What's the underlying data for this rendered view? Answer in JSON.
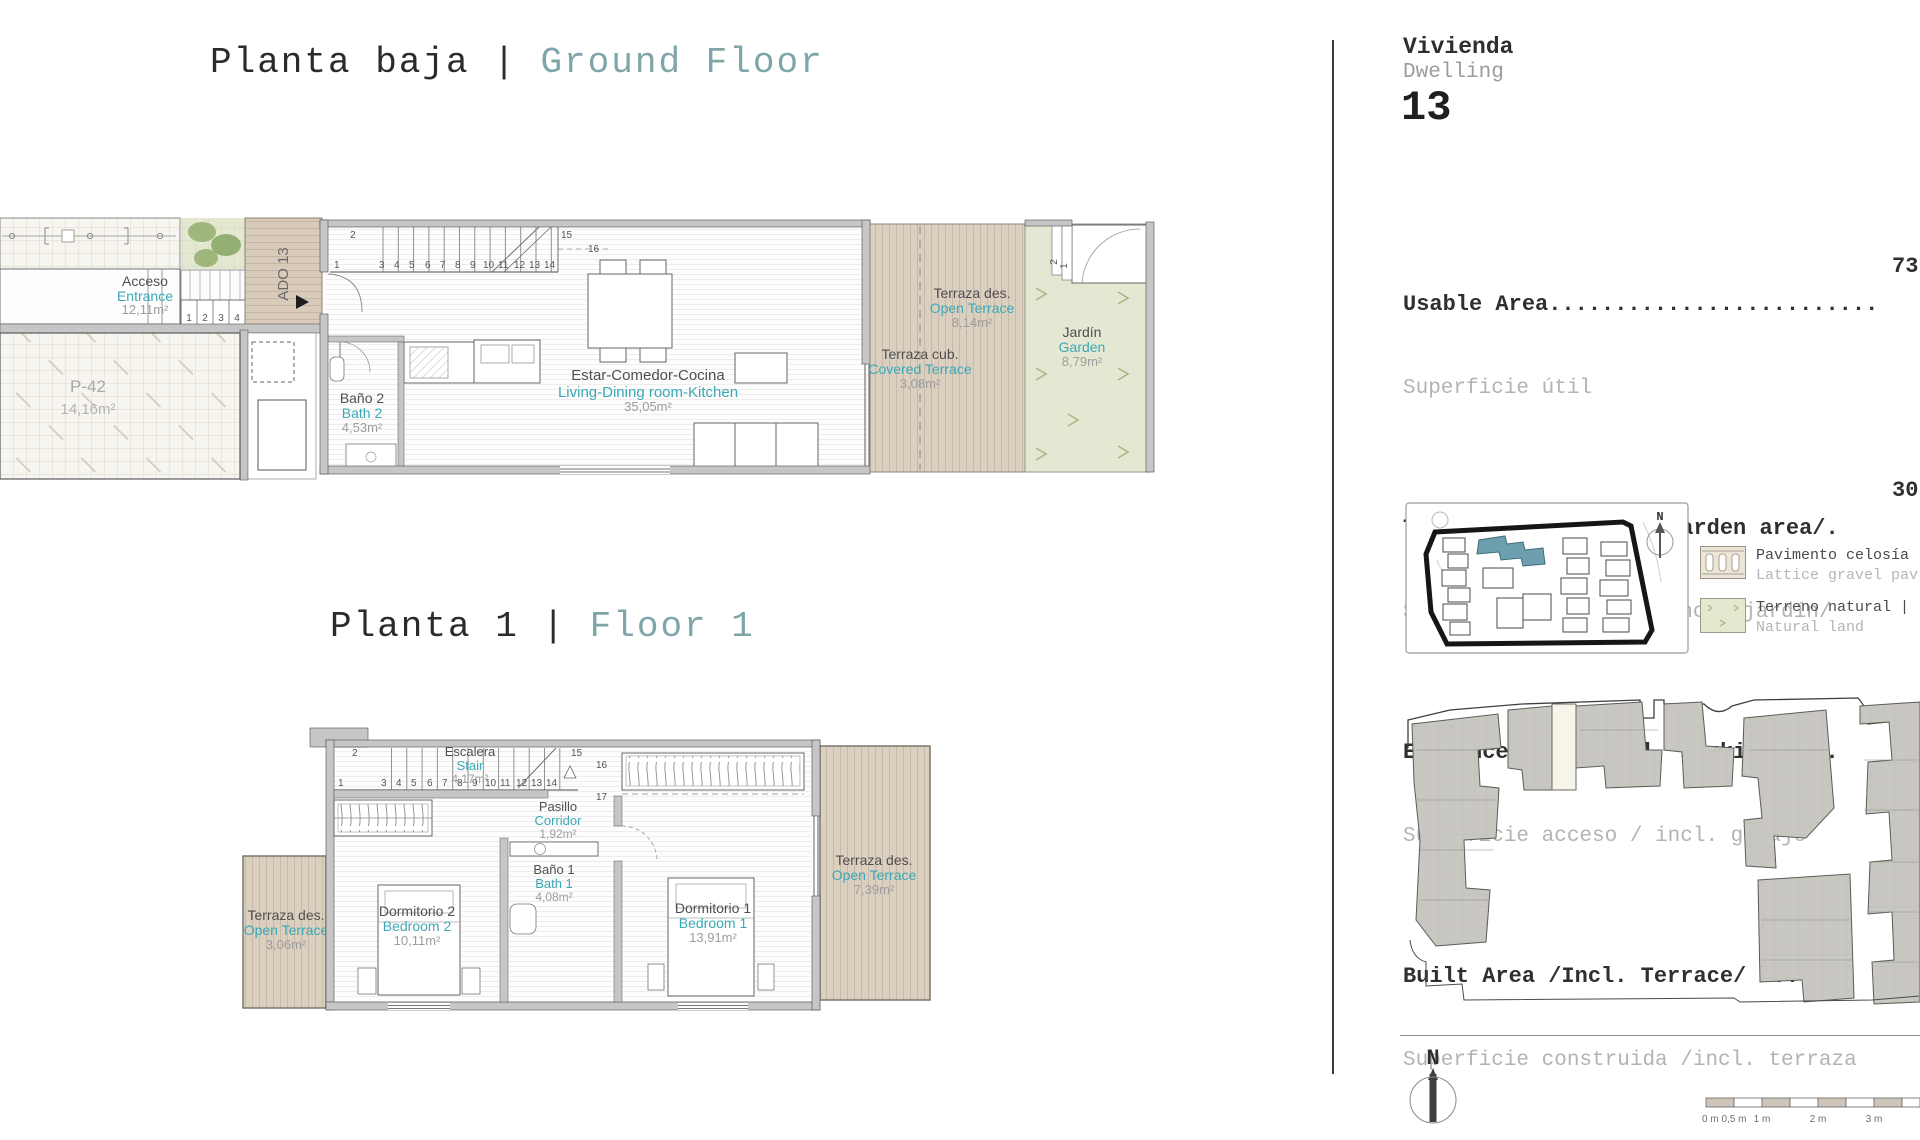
{
  "titles": {
    "ground": {
      "es": "Planta baja",
      "sep": " | ",
      "en": "Ground Floor"
    },
    "floor1": {
      "es": "Planta 1",
      "sep": " | ",
      "en": "Floor 1"
    }
  },
  "panel": {
    "dwelling_es": "Vivienda",
    "dwelling_en": "Dwelling",
    "dwelling_number": "13",
    "areas": [
      {
        "en": "Usable Area.........................",
        "es": "Superficie útil",
        "value": "73"
      },
      {
        "en": "Terrace area /Incl. Garden area/.",
        "es": "Superficie terrazas /incl. jardín/",
        "value": "30"
      },
      {
        "en": "Entrance area /Incl. Parking /...",
        "es": "Superficie acceso / incl. garaje",
        "value": "26"
      },
      {
        "en": "Built Area /Incl. Terrace/ ......",
        "es": "Superficie construida /incl. terraza",
        "value": "113"
      }
    ],
    "legend": [
      {
        "es": "Pavimento celosía",
        "en": "Lattice gravel pav"
      },
      {
        "es": "Terreno natural |",
        "en": "Natural land"
      }
    ],
    "north_label": "N",
    "scale_labels": [
      "0 m",
      "0,5 m",
      "1 m",
      "2 m",
      "3 m"
    ]
  },
  "ground": {
    "acceso": {
      "es": "Acceso",
      "en": "Entrance",
      "m2": "12,11m²"
    },
    "parking": {
      "name": "P-42",
      "m2": "14,16m²"
    },
    "ado": "ADO 13",
    "bath2": {
      "es": "Baño 2",
      "en": "Bath 2",
      "m2": "4,53m²"
    },
    "living": {
      "es": "Estar-Comedor-Cocina",
      "en": "Living-Dining room-Kitchen",
      "m2": "35,05m²"
    },
    "open_terrace": {
      "es": "Terraza des.",
      "en": "Open Terrace",
      "m2": "8,14m²"
    },
    "covered_terrace": {
      "es": "Terraza cub.",
      "en": "Covered Terrace",
      "m2": "3,08m²"
    },
    "garden": {
      "es": "Jardín",
      "en": "Garden",
      "m2": "8,79m²"
    }
  },
  "floor1": {
    "stair": {
      "es": "Escalera",
      "en": "Stair",
      "m2": "4,17m²"
    },
    "corridor": {
      "es": "Pasillo",
      "en": "Corridor",
      "m2": "1,92m²"
    },
    "bath1": {
      "es": "Baño 1",
      "en": "Bath 1",
      "m2": "4,08m²"
    },
    "bedroom2": {
      "es": "Dormitorio 2",
      "en": "Bedroom 2",
      "m2": "10,11m²"
    },
    "bedroom1": {
      "es": "Dormitorio 1",
      "en": "Bedroom 1",
      "m2": "13,91m²"
    },
    "terrace_left": {
      "es": "Terraza des.",
      "en": "Open Terrace",
      "m2": "3,06m²"
    },
    "terrace_right": {
      "es": "Terraza des.",
      "en": "Open Terrace",
      "m2": "7,39m²"
    }
  },
  "stairs": {
    "numbers": [
      "1",
      "2",
      "3",
      "4",
      "5",
      "6",
      "7",
      "8",
      "9",
      "10",
      "11",
      "12",
      "13",
      "14",
      "15",
      "16",
      "17"
    ]
  },
  "entry_steps": [
    "1",
    "2",
    "3",
    "4"
  ],
  "garden_steps": [
    "2",
    "1"
  ],
  "colors": {
    "accent_teal": "#3aa8b6",
    "title_teal": "#7ea6a9",
    "terrace_tan": "#dbcfc0",
    "garden_green": "#e4e8d3",
    "highlight_teal": "#6d9fae",
    "wall_gray": "#c6c6c6"
  }
}
